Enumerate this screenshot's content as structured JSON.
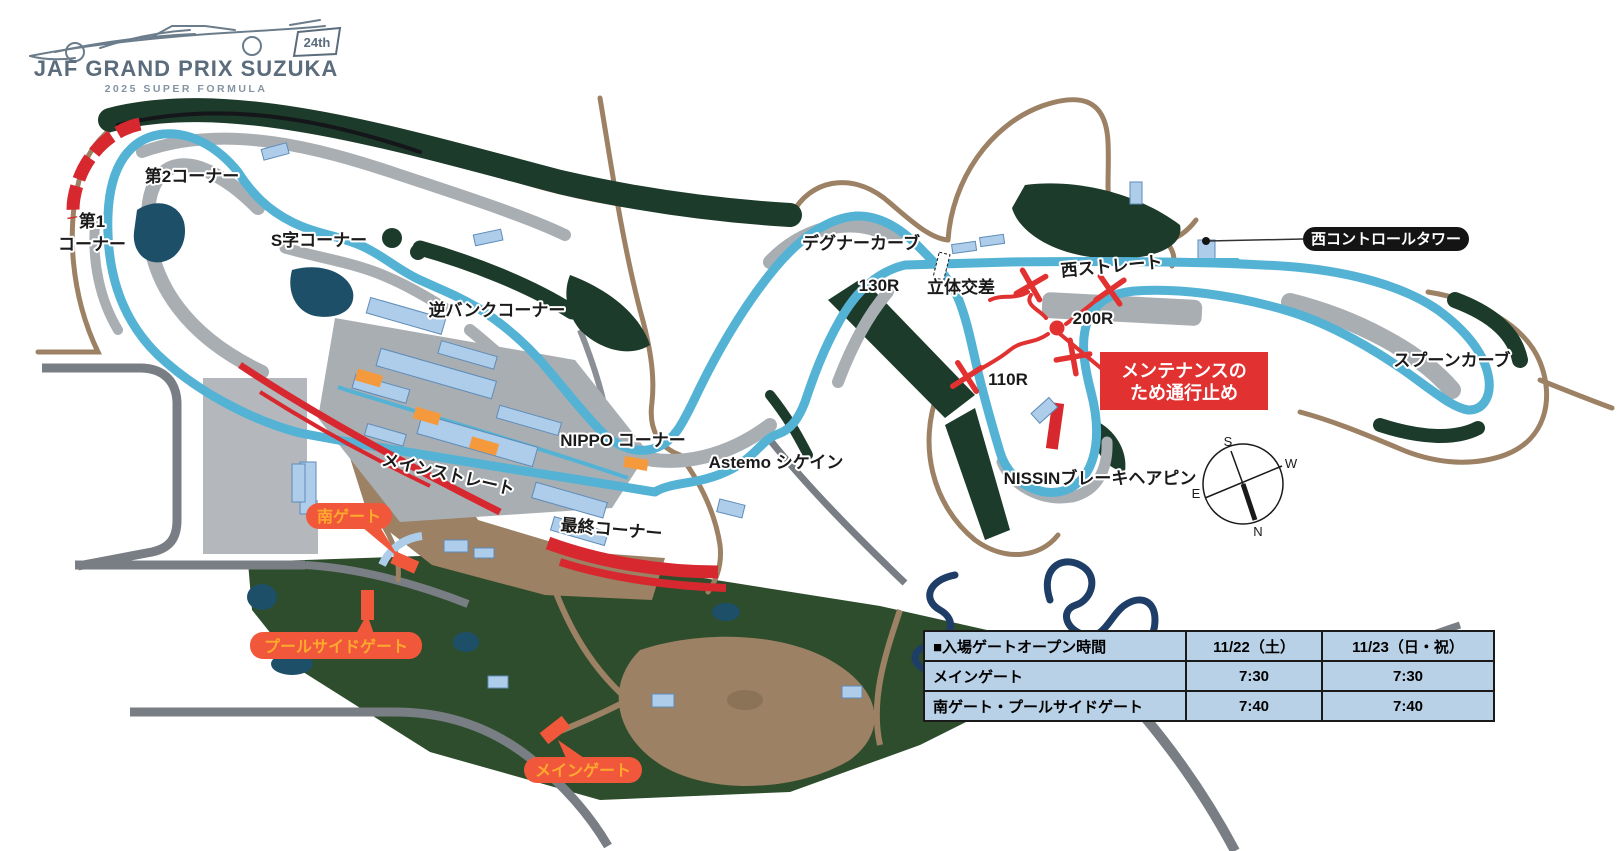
{
  "logo": {
    "title": "JAF GRAND PRIX SUZUKA",
    "subtitle": "2025 SUPER FORMULA",
    "badge": "24th"
  },
  "map": {
    "corner_labels": {
      "corner1_line1": "第1",
      "corner1_line2": "コーナー",
      "corner2": "第2コーナー",
      "s_curves": "S字コーナー",
      "reverse_bank": "逆バンクコーナー",
      "degner": "デグナーカーブ",
      "r130": "130R",
      "grade_crossing": "立体交差",
      "west_straight": "西ストレート",
      "r200": "200R",
      "r110": "110R",
      "spoon": "スプーンカーブ",
      "nippo": "NIPPO コーナー",
      "astemo": "Astemo シケイン",
      "main_straight": "メインストレート",
      "final_corner": "最終コーナー",
      "nissin_hairpin": "NISSINブレーキヘアピン"
    },
    "facilities": {
      "west_control_tower": "西コントロールタワー"
    },
    "closure_note": {
      "line1": "メンテナンスの",
      "line2": "ため通行止め"
    },
    "gates": {
      "south": "南ゲート",
      "poolside": "プールサイドゲート",
      "main": "メインゲート"
    },
    "compass": {
      "n": "N",
      "s": "S",
      "e": "E",
      "w": "W"
    }
  },
  "gate_schedule_table": {
    "header": {
      "title": "■入場ゲートオープン時間",
      "day1": "11/22（土）",
      "day2": "11/23（日・祝）"
    },
    "rows": [
      {
        "gate": "メインゲート",
        "day1": "7:30",
        "day2": "7:30"
      },
      {
        "gate": "南ゲート・プールサイドゲート",
        "day1": "7:40",
        "day2": "7:40"
      }
    ]
  },
  "colors": {
    "track_blue": "#54b3d5",
    "infield_gray": "#a9aeb3",
    "forest_green": "#1d3b2b",
    "park_green": "#2e4d2c",
    "road_brown": "#9c8164",
    "road_gray": "#797e85",
    "stand_red": "#d7282f",
    "closure_red": "#e23131",
    "gate_orange": "#f1583b",
    "gate_text_orange": "#ffaa2e",
    "structure_orange": "#f59a3c",
    "building_blue": "#aecdea",
    "pond_teal": "#1d4f68",
    "kart_navy": "#1e3e68",
    "table_blue": "#b9d1e6",
    "logo_slate": "#5b6c7c"
  }
}
